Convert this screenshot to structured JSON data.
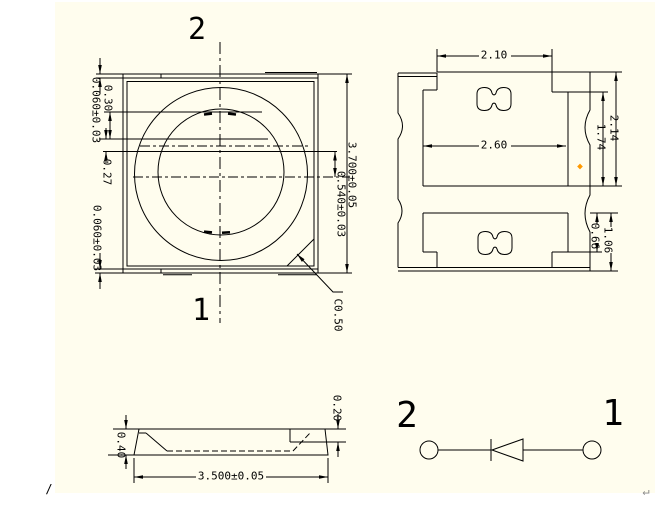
{
  "colors": {
    "paper": "#fffdee",
    "line": "#000000",
    "marker_dot": "#ff9900"
  },
  "top_view": {
    "pin2": "2",
    "pin1": "1",
    "dim_top_gap": "0.060±0.03",
    "dim_strip": "0.30",
    "dim_offset": "0.27",
    "dim_bottom_gap": "0.060±0.03",
    "dim_body_height": "3.700±0.05",
    "dim_lens_offset": "0.540±0.03",
    "dim_chamfer": "C0.50"
  },
  "bottom_view": {
    "dim_tab_width": "2.10",
    "dim_pad_width": "2.60",
    "dim_right_height": "2.14",
    "dim_pad_height": "1.74",
    "dim_anode_step": "0.66",
    "dim_anode_height": "1.06"
  },
  "side_view": {
    "dim_thickness": "0.40",
    "dim_step": "0.20",
    "dim_length": "3.500±0.05"
  },
  "circuit": {
    "pin2": "2",
    "pin1": "1"
  },
  "artifacts": {
    "slash": "/",
    "paragraph_mark": "↵"
  }
}
